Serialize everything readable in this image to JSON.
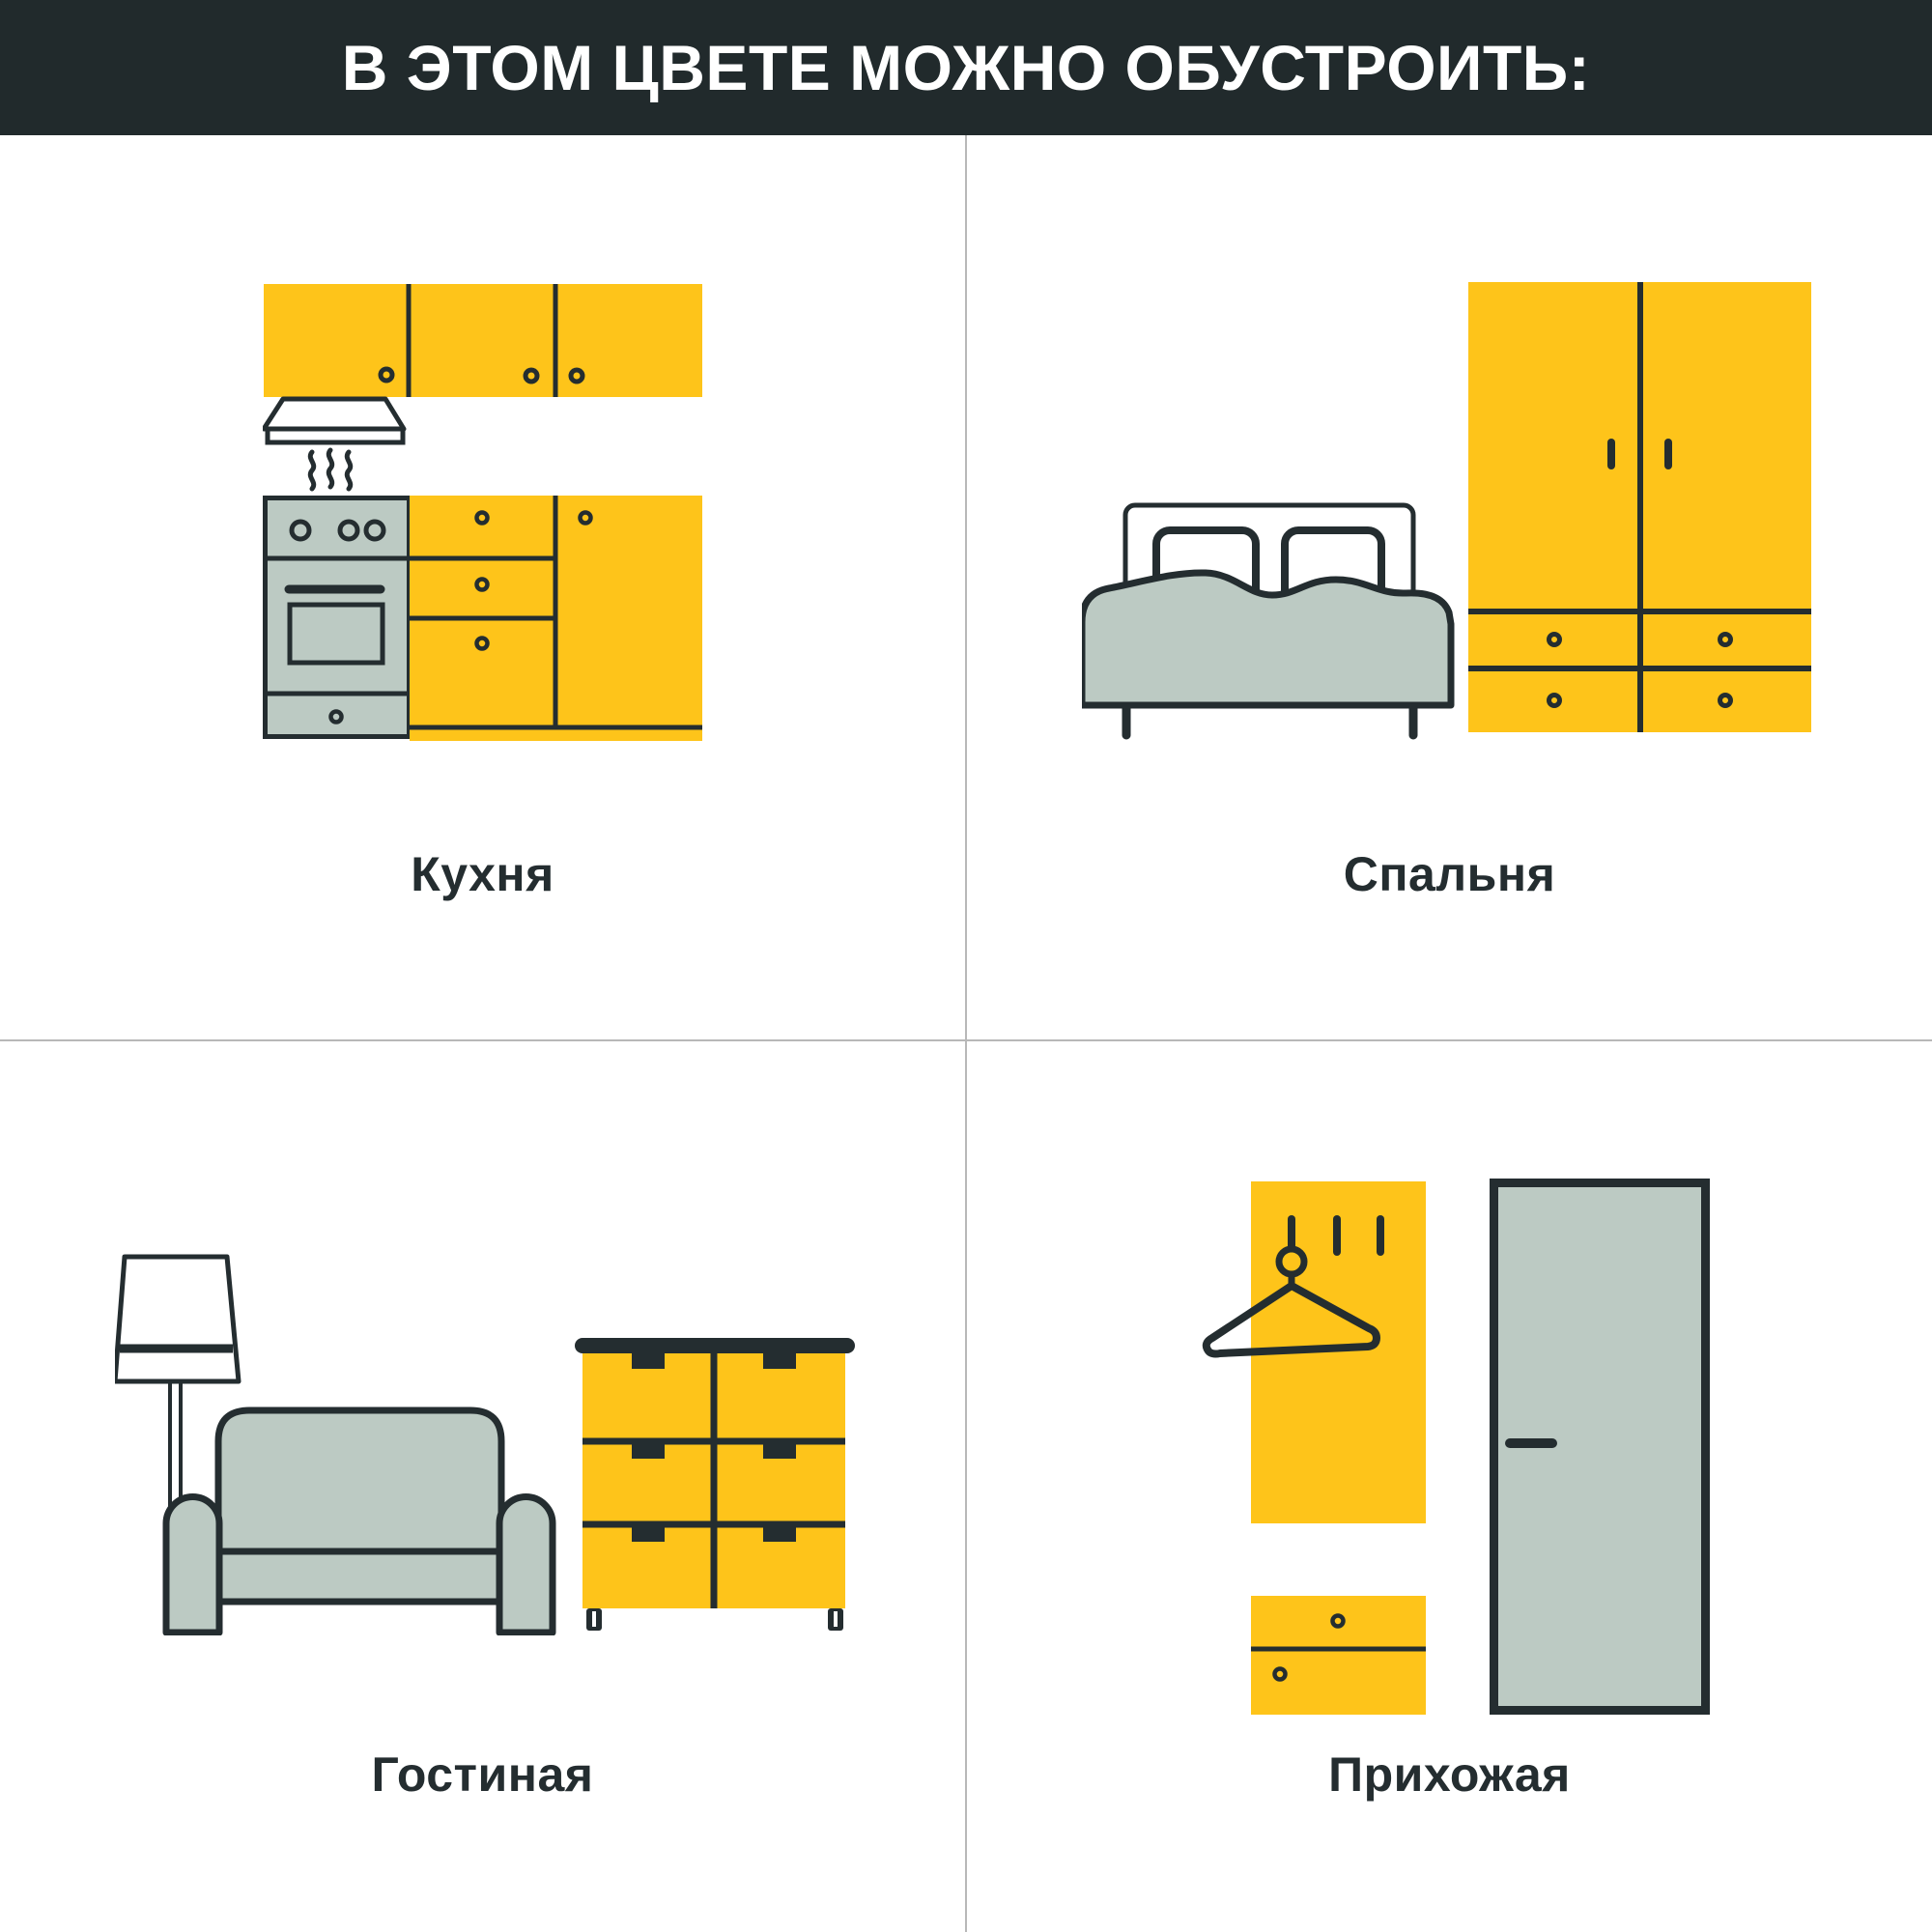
{
  "header": {
    "title": "В ЭТОМ ЦВЕТЕ МОЖНО ОБУСТРОИТЬ:",
    "background_color": "#212A2C",
    "text_color": "#FFFFFF"
  },
  "colors": {
    "accent_yellow": "#FEC41A",
    "furniture_gray_green": "#BCCAC3",
    "outline_dark": "#242D30",
    "grid_divider_gray": "#B8B8B8",
    "page_background": "#FFFFFF"
  },
  "grid": {
    "rows": 2,
    "columns": 2
  },
  "sections": [
    {
      "id": "kitchen",
      "label": "Кухня",
      "illustration": "kitchen-icon"
    },
    {
      "id": "bedroom",
      "label": "Спальня",
      "illustration": "bedroom-icon"
    },
    {
      "id": "living-room",
      "label": "Гостиная",
      "illustration": "living-room-icon"
    },
    {
      "id": "hallway",
      "label": "Прихожая",
      "illustration": "hallway-icon"
    }
  ]
}
